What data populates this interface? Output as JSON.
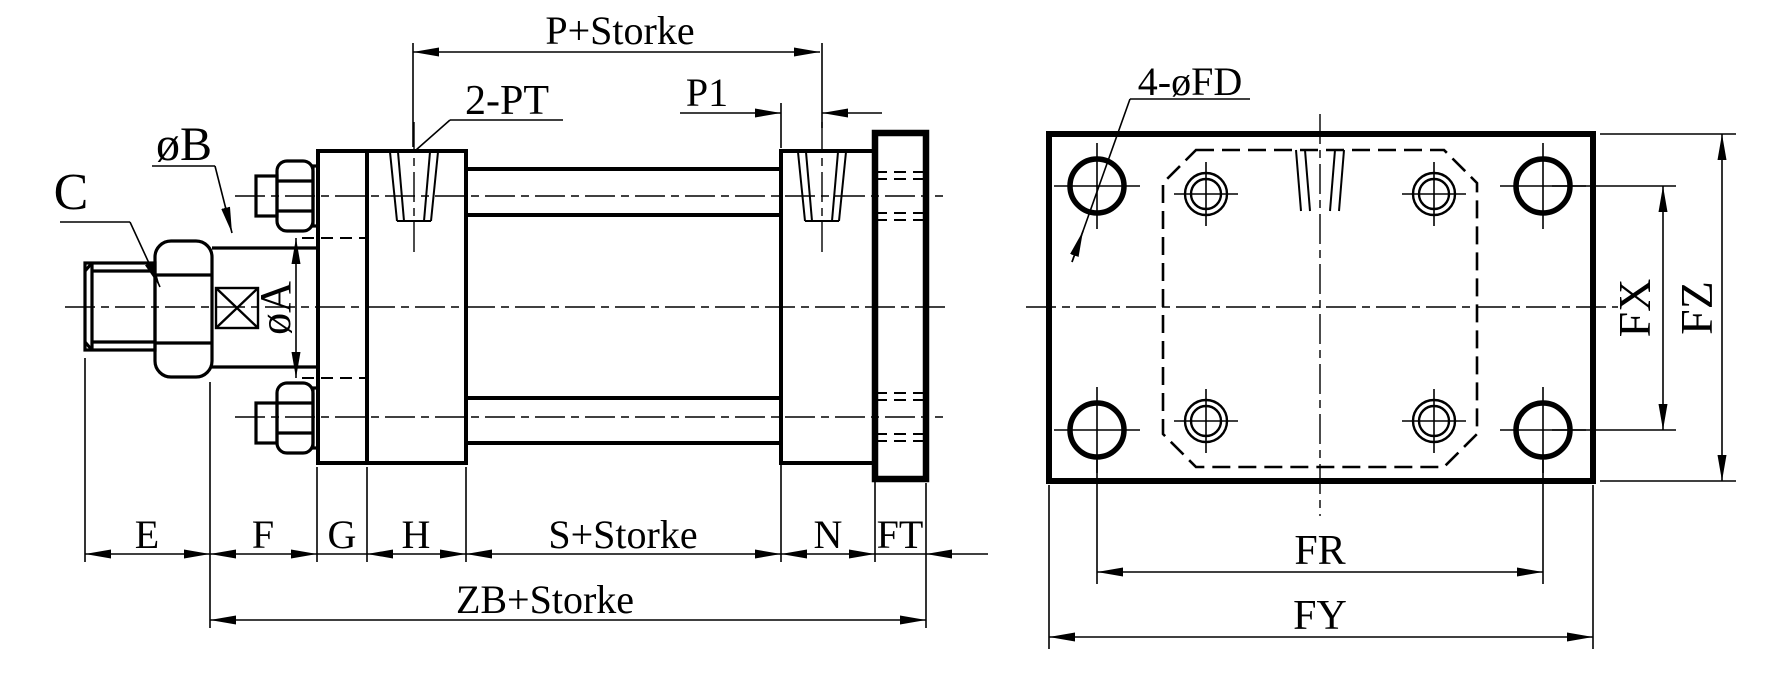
{
  "colors": {
    "background": "#ffffff",
    "line": "#000000"
  },
  "views": {
    "side": {
      "labels": {
        "p_storke": "P+Storke",
        "p1": "P1",
        "ports": "2-PT",
        "rod_thread": "C",
        "rod_boss_dia": "øB",
        "rod_dia": "øA",
        "e": "E",
        "f": "F",
        "g": "G",
        "h": "H",
        "s_storke": "S+Storke",
        "n": "N",
        "ft": "FT",
        "zb_storke": "ZB+Storke"
      }
    },
    "end": {
      "labels": {
        "mount_holes": "4-øFD",
        "fx": "FX",
        "fz": "FZ",
        "fr": "FR",
        "fy": "FY"
      }
    }
  }
}
